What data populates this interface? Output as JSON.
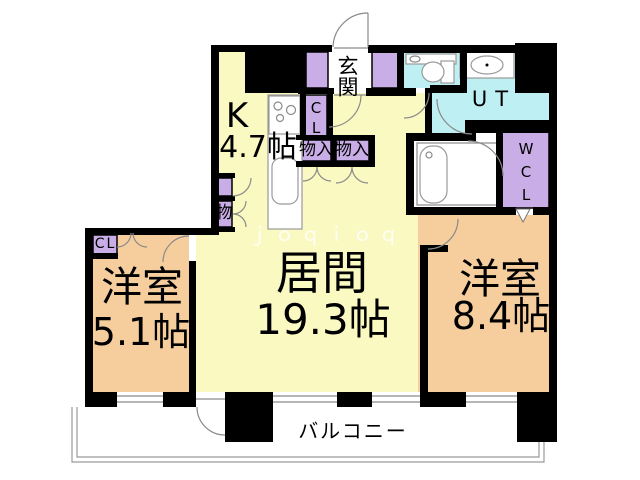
{
  "watermark": "ｊｏｑｉｏｑ",
  "rooms": {
    "kitchen": {
      "name": "K",
      "size": "4.7帖"
    },
    "entrance": {
      "name": "玄関"
    },
    "utility": {
      "name": "UT"
    },
    "walk_in_closet": {
      "name": "WCL"
    },
    "living": {
      "name": "居間",
      "size": "19.3帖"
    },
    "bedroom_left": {
      "name": "洋室",
      "size": "5.1帖"
    },
    "bedroom_right": {
      "name": "洋室",
      "size": "8.4帖"
    },
    "balcony": {
      "name": "バルコニー"
    }
  },
  "closets": {
    "hall_cl": "CL",
    "bedroom_cl": "CL",
    "hall_storage_1": "物入",
    "hall_storage_2": "物入",
    "living_storage": "物"
  },
  "colors": {
    "room_yellow": "#FAF9C2",
    "room_orange": "#F6CE9E",
    "room_cyan": "#BEEFF2",
    "closet_purple": "#C9ADE6",
    "wall_black": "#000000"
  }
}
